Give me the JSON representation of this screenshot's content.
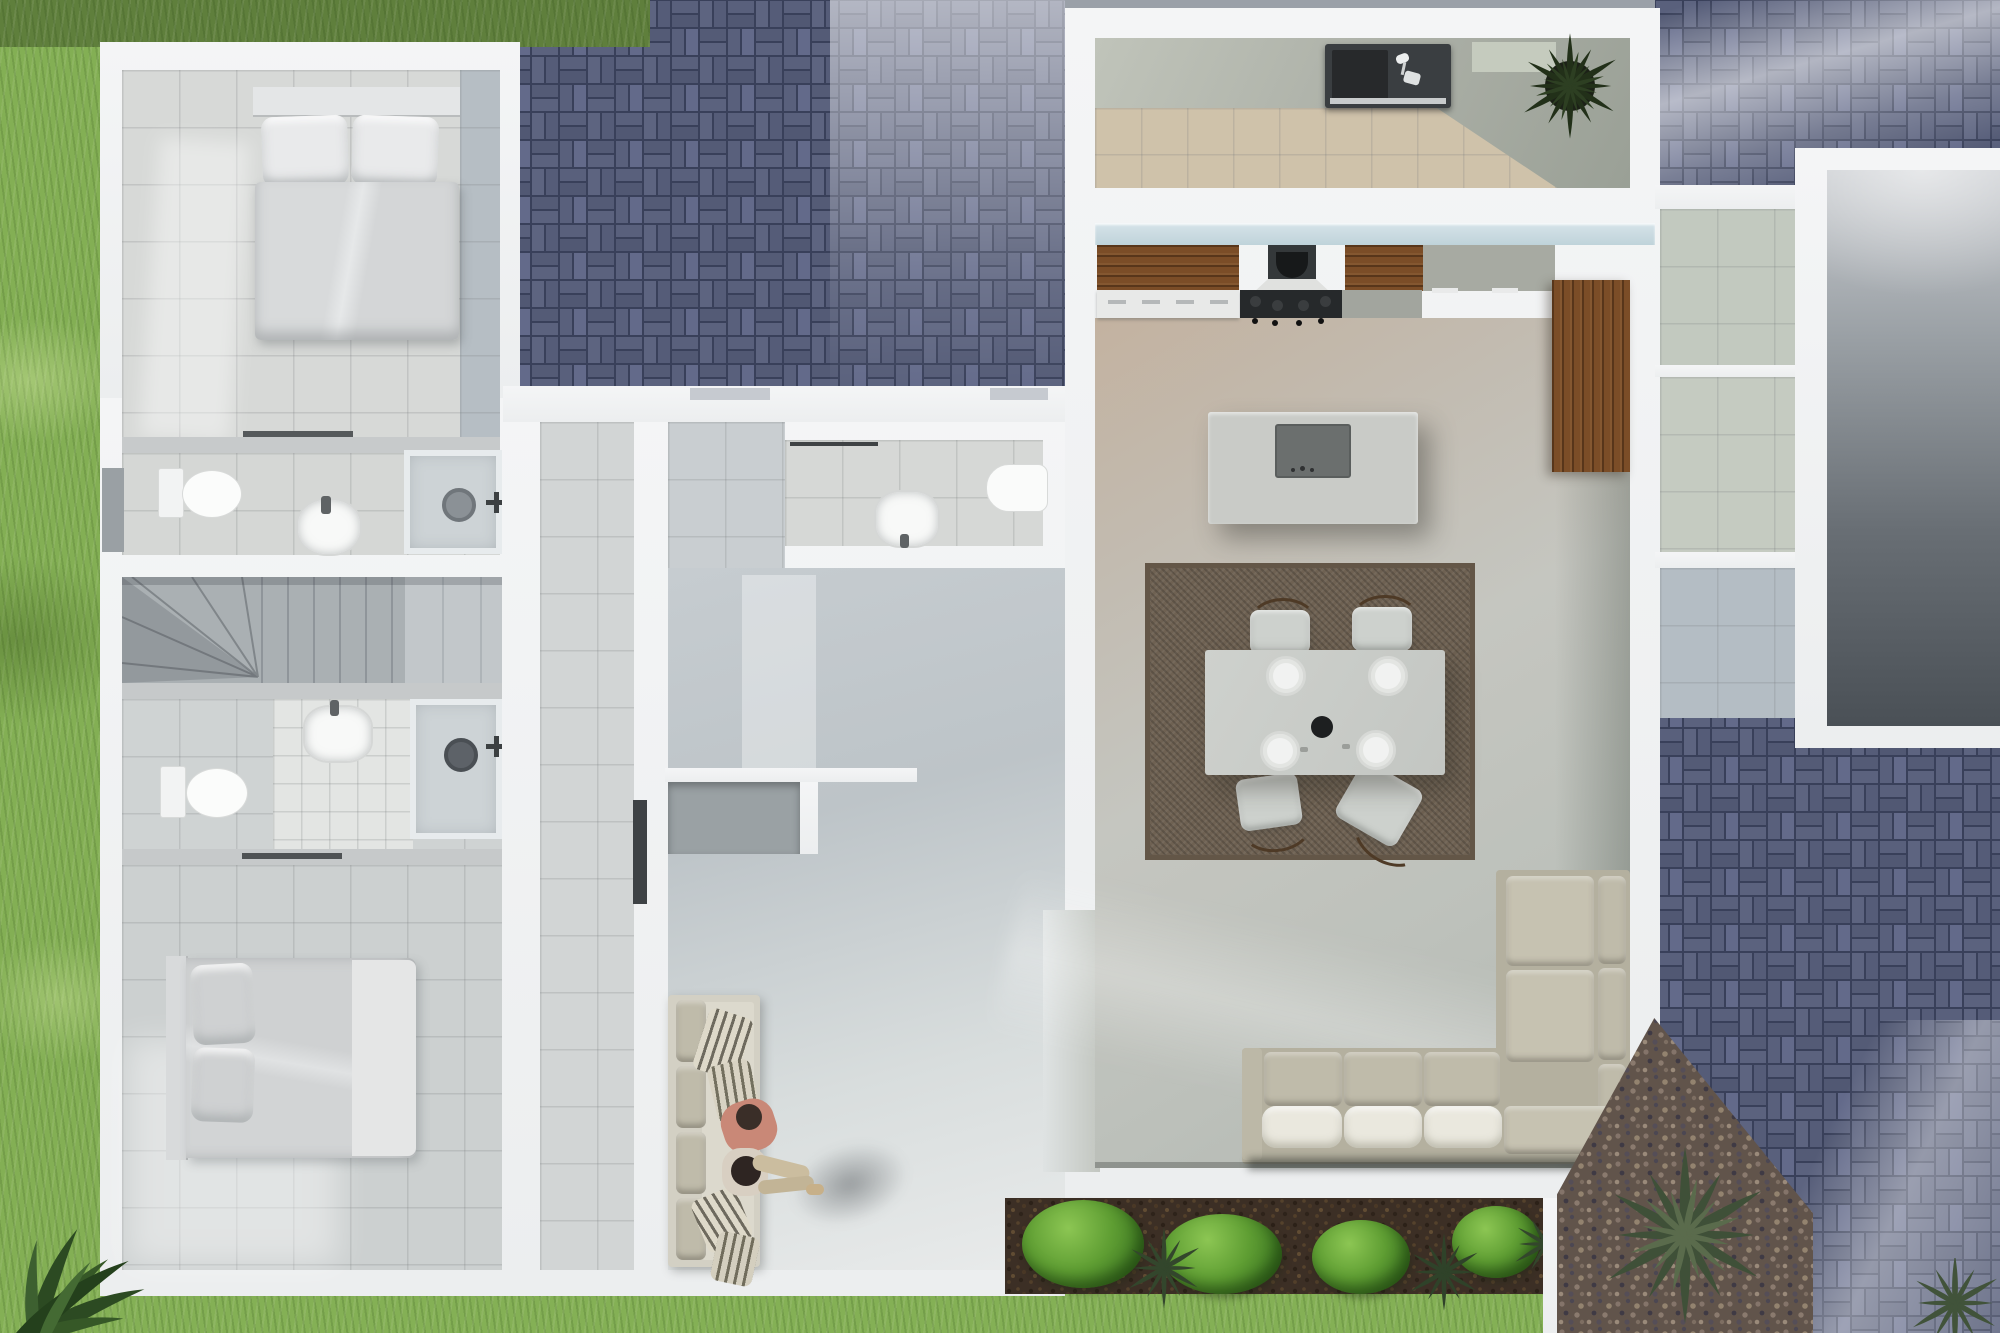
{
  "meta": {
    "type": "architectural-render",
    "view": "top-down 3D floor plan, photorealistic",
    "visible_text": "none"
  },
  "palette": {
    "grass": "#84b055",
    "grass_dark": "#5f7f3c",
    "paver_brick": "#59607c",
    "paver_grout": "#39405a",
    "wall_white": "#f2f3f4",
    "tile_light": "#d7d9d7",
    "tile_cool": "#c3c9cd",
    "tile_warm": "#c3b2a0",
    "glass": "#cfdfe6",
    "wood": "#7b4d27",
    "rug": "#6e6152",
    "island": "#c9cbc7",
    "sofa_fabric": "#b4b09f",
    "seat_white": "#eae8de",
    "pool_dark": "#4a5056",
    "mulch": "#3c2f25",
    "bush_green": "#5f9e33",
    "gravel": "#61544b",
    "shirt_salmon": "#c98877"
  },
  "scene": {
    "rooms": [
      {
        "id": "bedroom-1",
        "label": "Bedroom top-left with double bed, two pillows and duvet"
      },
      {
        "id": "bathroom-1",
        "label": "Bathroom with wall toilet, round basin and walk-in shower"
      },
      {
        "id": "staircase",
        "label": "Winder staircase with fanned and straight treads"
      },
      {
        "id": "bathroom-2",
        "label": "Second bathroom with basin alcove, shower and toilet"
      },
      {
        "id": "bedroom-2",
        "label": "Bedroom bottom-left with double bed against side wall"
      },
      {
        "id": "powder-room",
        "label": "Powder room with basin and toilet"
      },
      {
        "id": "entry-hall",
        "label": "Entry hall with bench sofa, striped pillows and two people"
      },
      {
        "id": "kitchen",
        "label": "Kitchen with wood cabinets, extractor hood, cooktop and island"
      },
      {
        "id": "dining",
        "label": "Dining area: table for four with plates on a brown rug"
      },
      {
        "id": "living",
        "label": "Living area with L-shaped sectional sofa and white seat cushions"
      },
      {
        "id": "terrace-kitchen",
        "label": "Top terrace counter with dark sink unit and potted plant"
      },
      {
        "id": "pool",
        "label": "Dark reflective pool pad on the right edge"
      },
      {
        "id": "garden",
        "label": "Planting bed with shrubs, agaves and mulch"
      },
      {
        "id": "paving",
        "label": "Blue-grey basket-weave brick paving"
      },
      {
        "id": "lawn",
        "label": "Lawn strips along the left, top and bottom edges"
      }
    ],
    "counts": {
      "beds": 2,
      "bathrooms": 3,
      "dining_seats": 4,
      "dining_plates": 4,
      "people": 2,
      "showers": 2,
      "toilets": 3,
      "basins": 4
    }
  }
}
